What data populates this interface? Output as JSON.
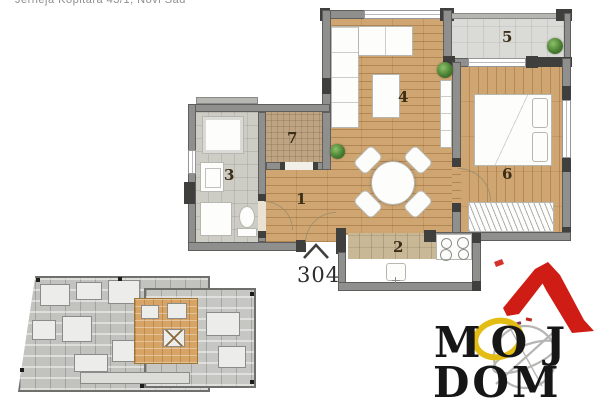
{
  "header": {
    "address": "Jerneja Kopitara 43/1, Novi Sad"
  },
  "floorplan": {
    "apartment_number": "304",
    "rooms": [
      {
        "label": "1"
      },
      {
        "label": "2"
      },
      {
        "label": "3"
      },
      {
        "label": "4"
      },
      {
        "label": "5"
      },
      {
        "label": "6"
      },
      {
        "label": "7"
      }
    ]
  },
  "logo": {
    "word1_letters": [
      "M",
      "O",
      "J"
    ],
    "word2": "DOM"
  },
  "colors": {
    "wood": "#cfa672",
    "wall": "#8f8f8d",
    "wall_dark": "#3f3f3d",
    "tile": "#cdccc5",
    "terrace": "#dadad6",
    "counter": "#c8b896",
    "closet": "#bfa483",
    "plant": "#4a7f33",
    "highlight": "#d8a466",
    "logo_red": "#cf1d15",
    "logo_yellow": "#e3bd14"
  }
}
